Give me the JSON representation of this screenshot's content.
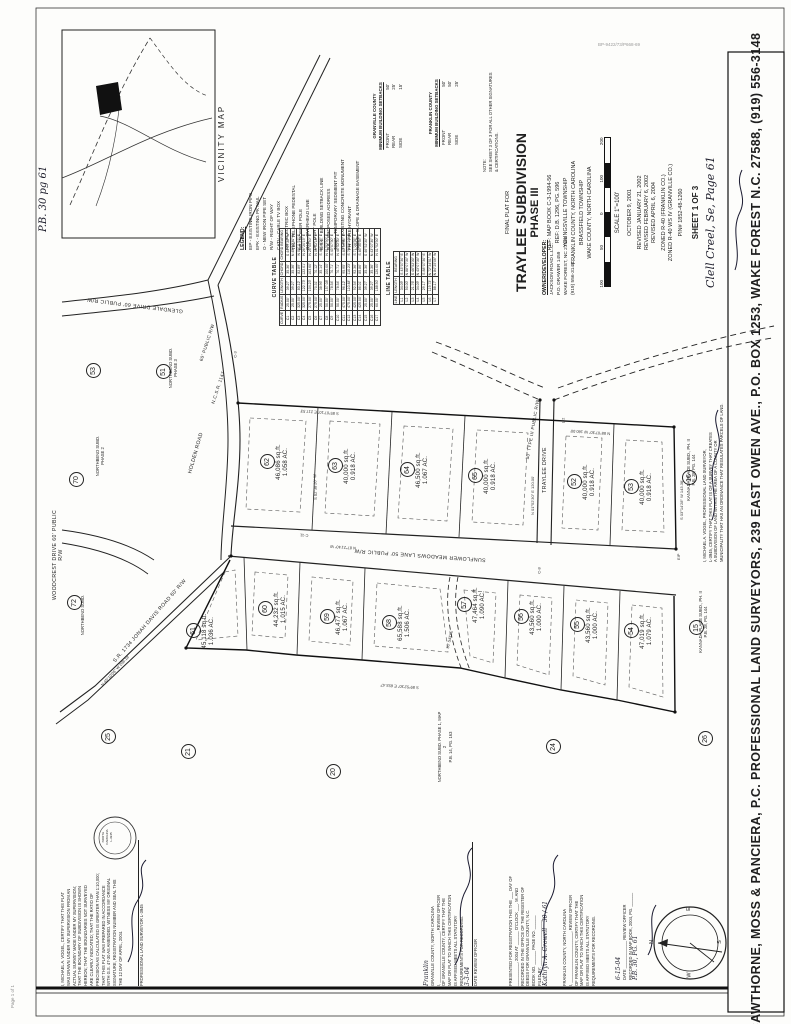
{
  "sheet": {
    "scan_artifact": "BP-9422/73/P668-69",
    "page_footer": "Page 1 of 1",
    "pb_note": "P.B. 30 pg 61",
    "clell_note": "Clell Creel, Se, Page 61"
  },
  "vicinity": {
    "title": "VICINITY MAP"
  },
  "legend": {
    "title": "LEGEND:",
    "items": [
      "EIP - EXISTING IRON PIPE",
      "EPK - EXISTING PK NAIL",
      "O - NEW IRON PIPE SET",
      "R/W - RIGHT OF WAY",
      "CATV - CABLE TV BOX",
      "EB - ELECTRIC BOX",
      "TEL - TELEPHONE PEDESTAL",
      "PP - POWER POLE",
      "OHL - OVERHEAD LINE",
      "LP - LIGHT POLE",
      "B.S.L. - BUILDING SETBACK LINE",
      "P.A. - PROPOSED ADDRESS",
      "TCSP - TEMPORARY SEDIMENT PIT",
      "TCM - EXISTING CONCRETE MONUMENT",
      "FH - FIRE HYDRANT",
      "S&D/E - SLOPE & DRAINAGE EASEMENT"
    ]
  },
  "setbacks": {
    "granville": {
      "title": "GRANVILLE COUNTY",
      "subtitle": "MINIMUM BUILDING SETBACKS",
      "rows": [
        [
          "FRONT",
          "50'"
        ],
        [
          "REAR",
          "25'"
        ],
        [
          "SIDE",
          "15'"
        ]
      ]
    },
    "franklin": {
      "title": "FRANKLIN COUNTY",
      "subtitle": "MINIMUM BUILDING SETBACKS",
      "rows": [
        [
          "FRONT",
          "50'"
        ],
        [
          "REAR",
          "50'"
        ],
        [
          "SIDE",
          "25'"
        ]
      ]
    }
  },
  "note": {
    "lines": [
      "NOTE:",
      "SEE SHEET 3 OF 3 FOR ALL OTHER SIGNATURES",
      "& CERTIFICATIONS."
    ]
  },
  "curve_table": {
    "title": "CURVE TABLE",
    "headers": [
      "CURVE",
      "RADIUS",
      "LENGTH",
      "CHORD",
      "CHORD BEARING"
    ],
    "rows": [
      [
        "C1",
        "25.00'",
        "39.27'",
        "35.36'",
        "S 44°07'30\" W"
      ],
      [
        "C2",
        "25.00'",
        "39.27'",
        "35.36'",
        "N 45°52'30\" W"
      ],
      [
        "C3",
        "325.00'",
        "83.12'",
        "82.89'",
        "N 08°11'22\" E"
      ],
      [
        "C4",
        "325.00'",
        "122.73'",
        "122.01'",
        "N 26°20'15\" E"
      ],
      [
        "C5",
        "275.00'",
        "104.23'",
        "103.60'",
        "N 25°05'40\" E"
      ],
      [
        "C6",
        "275.00'",
        "70.31'",
        "70.12'",
        "N 06°52'18\" E"
      ],
      [
        "C7",
        "25.00'",
        "38.96'",
        "35.14'",
        "S 46°10'25\" E"
      ],
      [
        "C8",
        "50.00'",
        "157.08'",
        "100.00'",
        "N 01°52'30\" E"
      ],
      [
        "C9",
        "50.00'",
        "78.54'",
        "70.71'",
        "S 43°07'30\" E"
      ],
      [
        "C10",
        "50.00'",
        "78.54'",
        "70.71'",
        "N 46°52'30\" E"
      ],
      [
        "C11",
        "475.00'",
        "96.12'",
        "95.95'",
        "S 83°19'45\" E"
      ],
      [
        "C12",
        "475.00'",
        "110.48'",
        "110.23'",
        "S 70°52'10\" E"
      ],
      [
        "C13",
        "425.00'",
        "92.54'",
        "92.36'",
        "S 71°28'35\" E"
      ],
      [
        "C14",
        "425.00'",
        "86.01'",
        "85.86'",
        "S 83°30'55\" E"
      ],
      [
        "C15",
        "25.00'",
        "39.27'",
        "35.36'",
        "S 46°52'30\" W"
      ],
      [
        "C16",
        "25.00'",
        "39.27'",
        "35.36'",
        "N 43°07'30\" W"
      ],
      [
        "C17",
        "60.00'",
        "188.50'",
        "120.00'",
        "N 01°52'30\" E"
      ]
    ]
  },
  "line_table": {
    "title": "LINE TABLE",
    "headers": [
      "LINE",
      "LENGTH",
      "BEARING"
    ],
    "rows": [
      [
        "L1",
        "34.09'",
        "S 43°07'30\" E"
      ],
      [
        "L2",
        "50.00'",
        "N 88°07'30\" W"
      ],
      [
        "L3",
        "21.76'",
        "S 46°52'30\" W"
      ],
      [
        "L4",
        "34.09'",
        "N 43°07'30\" W"
      ],
      [
        "L5",
        "29.17'",
        "S 88°07'30\" E"
      ],
      [
        "L6",
        "119.73'",
        "N 72°34'51\" W"
      ],
      [
        "L7",
        "88.17'",
        "N 84°25'06\" W"
      ]
    ]
  },
  "title_block": {
    "final_plat": "FINAL PLAT FOR",
    "title": "TRAYLEE SUBDIVISION",
    "phase": "PHASE III",
    "ref1": "REF: MAP BOOK C-3-1994-56",
    "ref2": "REF: D.B. 1296, PG. 596",
    "twp1": "YOUNGSVILLE TOWNSHIP",
    "cty1": "FRANKLIN COUNTY, NORTH CAROLINA",
    "twp2": "BRASSFIELD TOWNSHIP",
    "cty2": "WAKE COUNTY, NORTH CAROLINA",
    "scale_ticks": [
      "100",
      "50",
      "0",
      "100",
      "200"
    ],
    "scale": "SCALE   1\"=100'",
    "date": "OCTOBER 9, 2001",
    "rev1": "REVISED JANUARY 21, 2002",
    "rev2": "REVISED FEBRUARY 6, 2002",
    "rev3": "REVISED APRIL 6, 2004",
    "zone1": "ZONED R-40 (FRANKLIN CO.)",
    "zone2": "ZONED R-40 WS IV (GRANVILLE CO.)",
    "pin": "PIN# 1852-48-1260",
    "sheet_no": "SHEET 1 OF 3"
  },
  "owner": {
    "hd": "OWNER/DEVELOPER:",
    "l1": "JACKSON ROAD L.L.C.",
    "l2": "P.O. DRAWER 1459",
    "l3": "WAKE FOREST, NC 27588",
    "l4": "(919) 556-3148"
  },
  "roads": {
    "glendale": "GLENDALE DRIVE 60' PUBLIC R/W",
    "holden": "HOLDEN ROAD",
    "holden_rw": "60' PUBLIC R/W",
    "holden_sr": "N.C.S.R. 1147",
    "woodcrest": "WOODCREST DRIVE 60' PUBLIC R/W",
    "jonah": "S.R. 1734  JONAH DAVIS ROAD  60' R/W",
    "sunflower": "SUNFLOWER MEADOWS LANE   50' PUBLIC R/W",
    "traylee": "TRAYLEE DRIVE",
    "traylee_rw": "50' TYPE III PUBLIC R/W"
  },
  "lots": [
    {
      "num": "62",
      "sqft": "46,086 sq.ft.",
      "acres": "1.058 AC."
    },
    {
      "num": "63",
      "sqft": "40,000 sq.ft.",
      "acres": "0.918 AC."
    },
    {
      "num": "64",
      "sqft": "46,500 sq.ft.",
      "acres": "1.067 AC."
    },
    {
      "num": "65",
      "sqft": "40,000 sq.ft.",
      "acres": "0.918 AC."
    },
    {
      "num": "52",
      "sqft": "40,000 sq.ft.",
      "acres": "0.918 AC."
    },
    {
      "num": "53",
      "sqft": "40,000 sq.ft.",
      "acres": "0.918 AC."
    },
    {
      "num": "61",
      "sqft": "45,118 sq.ft.",
      "acres": "1.036 AC."
    },
    {
      "num": "60",
      "sqft": "44,232 sq.ft.",
      "acres": "1.015 AC."
    },
    {
      "num": "59",
      "sqft": "46,477 sq.ft.",
      "acres": "1.067 AC."
    },
    {
      "num": "58",
      "sqft": "65,588 sq.ft.",
      "acres": "1.506 AC."
    },
    {
      "num": "57",
      "sqft": "47,464 sq.ft.",
      "acres": "1.090 AC."
    },
    {
      "num": "56",
      "sqft": "43,560 sq.ft.",
      "acres": "1.000 AC."
    },
    {
      "num": "55",
      "sqft": "43,560 sq.ft.",
      "acres": "1.000 AC."
    },
    {
      "num": "54",
      "sqft": "47,019 sq.ft.",
      "acres": "1.079 AC."
    }
  ],
  "adjacent": [
    "53",
    "51",
    "70",
    "72",
    "25",
    "21",
    "20",
    "24",
    "26",
    "16",
    "15"
  ],
  "adjacent_notes": {
    "northbend3": [
      "NORTHBEND SUBD.",
      "PHASE 3"
    ],
    "northbend2": [
      "NORTHBEND SUBD.",
      "PHASE 2"
    ],
    "northbend": [
      "NORTHBEND SUBD."
    ],
    "northbend1": [
      "NORTHBEND SUBD. PHASE 1, MAP 2",
      "P.B. 14, PG. 163"
    ],
    "kannada": [
      "KANNADA PLACE SUBD., PH. II",
      "P.B. 28, PG. 144"
    ]
  },
  "bearings": [
    "S 85°07'10\" E  217.53'",
    "S 89°52'30\" E  653.47'",
    "N 01°52'30\" E  120.00'",
    "S 03°14'28\" W  143.38'",
    "N 87°21'40\" W",
    "S 02°38'20\" W",
    "N 45°10'05\" W  206.18'",
    "N 88°07'30\" W  160.00'",
    "30' S&D/E",
    "EIP"
  ],
  "markers": [
    "C-3",
    "C-8",
    "C-11",
    "L-2"
  ],
  "vogel_note": {
    "lines": [
      "I, MICHAEL A. VOGEL, PROFESSIONAL LAND SURVEYOR,",
      "L-3945, CERTIFY THAT THIS PLAT IS OF A SURVEY THAT CREATES",
      "A SUBDIVISION OF LAND WITHIN THE AREA OF A COUNTY OR",
      "MUNICIPALITY THAT HAS AN ORDINANCE THAT REGULATES PARCELS OF LAND."
    ]
  },
  "certs": {
    "surveyor": {
      "lines": [
        "I, MICHAEL A. VOGEL, CERTIFY THAT THIS PLAT",
        "WAS DRAWN UNDER MY SUPERVISION FROM AN",
        "ACTUAL SURVEY MADE UNDER MY SUPERVISION;",
        "THAT THE BOUNDARY OF SUBDIVISION IS SHOWN",
        "HEREON; THAT THE BOUNDARIES NOT SURVEYED",
        "ARE CLEARLY INDICATED; THAT THE RATIO OF",
        "PRECISION AS CALCULATED IS GREATER THAN 1:10,000;",
        "THAT THIS PLAT WAS PREPARED IN ACCORDANCE",
        "WITH G.S. 47-30 AS AMENDED. WITNESS MY ORIGINAL",
        "SIGNATURE, REGISTRATION NUMBER AND SEAL THIS",
        "THE 12 DAY OF APRIL, 2004."
      ],
      "sig_caption": "PROFESSIONAL LAND SURVEYOR   L-3945",
      "seal": [
        "NORTH",
        "CAROLINA",
        "L-3945"
      ]
    },
    "granville": {
      "hand_over": "Franklin",
      "lines": [
        "GRANVILLE COUNTY, NORTH CAROLINA",
        "I, ______________________, REVIEW OFFICER",
        "OF GRANVILLE COUNTY, CERTIFY THAT THE",
        "MAP OR PLAT TO WHICH THIS CERTIFICATION",
        "IS AFFIXED MEETS ALL STATUTORY",
        "REQUIREMENTS FOR RECORDING."
      ],
      "hand_date": "3-3-04",
      "sig_caption": "DATE                REVIEW OFFICER"
    },
    "registration": {
      "lines": [
        "PRESENTED FOR REGISTRATION THIS THE ___ DAY OF",
        "__________, 2004 AT ______ O'CLOCK ___. M. AND",
        "RECORDED IN THE OFFICE OF THE REGISTER OF",
        "DEEDS FOR GRANVILLE COUNTY, N.C.",
        "BOOK NO. ______   PAGE NO. ______",
        "FILED BY: ____________________"
      ],
      "hand_book": "30",
      "hand_page": "61",
      "hand_sig": "Kathryn A. Crowell"
    },
    "franklin": {
      "lines": [
        "FRANKLIN COUNTY, NORTH CAROLINA",
        "I, ______________________, REVIEW OFFICER",
        "OF FRANKLIN COUNTY, CERTIFY THAT THE",
        "MAP OR PLAT TO WHICH THIS CERTIFICATION",
        "IS AFFIXED MEETS ALL STATUTORY",
        "REQUIREMENTS FOR RECORDING."
      ]
    },
    "recorded": {
      "lines": [
        "DATE ____________      REVIEW OFFICER",
        "RECORDED IN MAP BOOK, 2004, PG. ______"
      ],
      "hand_date": "6-15-04",
      "hand_ref": "P.B. 30, PG. 61"
    }
  },
  "compass": {
    "n": "N",
    "e": "E",
    "s": "S",
    "w": "W"
  },
  "firm_strip": "CAWTHORNE, MOSS & PANCIERA, P.C. PROFESSIONAL LAND SURVEYORS, 239 EAST OWEN AVE., P.O. BOX 1253, WAKE FOREST N.C. 27588, (919) 556-3148"
}
